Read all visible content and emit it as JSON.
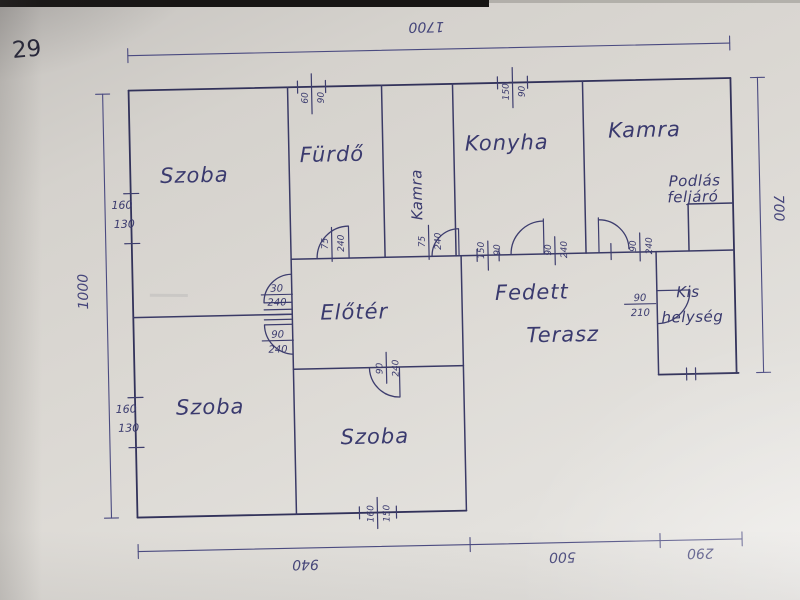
{
  "page_number": "29",
  "rooms": {
    "szoba_top_left": "Szoba",
    "furdo": "Fürdő",
    "kamra_mid": "Kamra",
    "konyha": "Konyha",
    "kamra_right": "Kamra",
    "eloter": "Előtér",
    "fedett_line1": "Fedett",
    "fedett_line2": "Terasz",
    "kis_line1": "Kis",
    "kis_line2": "helység",
    "szoba_bottom_left": "Szoba",
    "szoba_bottom_mid": "Szoba",
    "attic_line1": "Podlás",
    "attic_line2": "feljáró"
  },
  "dimensions": {
    "top": "1700",
    "left": "1000",
    "right": "700",
    "bottom_left": "940",
    "bottom_mid": "500",
    "bottom_right": "290"
  },
  "windows": {
    "furdo": {
      "n1": "60",
      "n2": "90"
    },
    "konyha": {
      "n1": "150",
      "n2": "90"
    },
    "left_top": {
      "n1": "160",
      "n2": "130"
    },
    "left_bottom": {
      "n1": "160",
      "n2": "130"
    },
    "bottom": {
      "n1": "160",
      "n2": "150"
    }
  },
  "doors": {
    "furdo": {
      "w": "75",
      "h": "240"
    },
    "kamra_mid": {
      "w": "75",
      "h": "240"
    },
    "szoba_upper": {
      "w": "30",
      "h": "240"
    },
    "szoba_lower": {
      "w": "90",
      "h": "240"
    },
    "szoba_bottom": {
      "w": "90",
      "h": "240"
    },
    "terasz_window": {
      "n1": "150",
      "n2": "90"
    },
    "konyha": {
      "w": "90",
      "h": "240"
    },
    "kamra_right": {
      "w": "90",
      "h": "240"
    },
    "kis_helyseg": {
      "w": "90",
      "h": "210"
    }
  }
}
